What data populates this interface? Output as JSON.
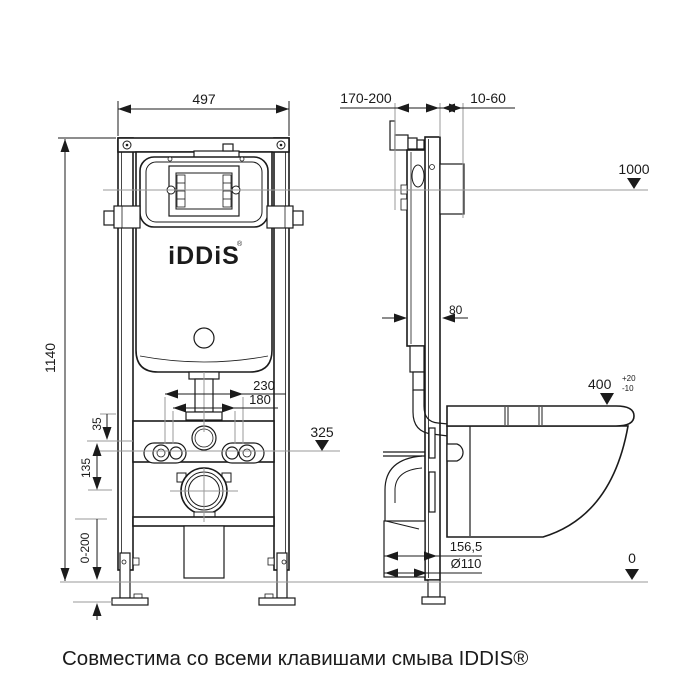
{
  "drawing": {
    "front_view": {
      "width": "497",
      "height": "1140",
      "bolt_spacing_outer": "230",
      "bolt_spacing_inner": "180",
      "offset_top": "35",
      "offset_mid": "135",
      "leg_adjust_range": "0-200",
      "logo": "iDDiS",
      "logo_mark": "®"
    },
    "side_view": {
      "install_depth_range": "170-200",
      "wall_gap_range": "10-60",
      "frame_depth": "80",
      "drain_offset": "156,5",
      "drain_diameter": "Ø110",
      "bowl_height": "400",
      "bowl_height_tol_plus": "+20",
      "bowl_height_tol_minus": "-10"
    },
    "levels": {
      "top": "1000",
      "bolts": "325",
      "floor": "0"
    }
  },
  "caption": "Совместима со всеми клавишами смыва IDDIS®",
  "colors": {
    "line": "#1b1b1b",
    "reference": "#9a9a9a",
    "background": "#ffffff"
  }
}
